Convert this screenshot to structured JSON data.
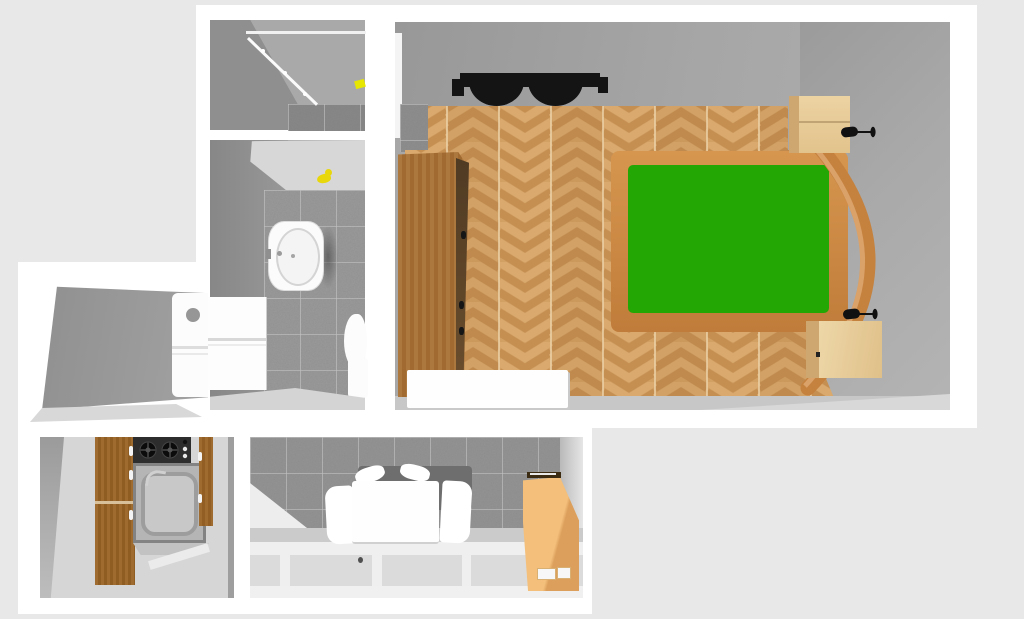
{
  "scene": {
    "description": "3D top-down rendered floor plan of a small apartment",
    "background_color": "#e8e8e8",
    "wall_color": "#ffffff",
    "interior_gray": "#a7a7a7"
  },
  "rooms": [
    {
      "id": "shower-room",
      "position": "top-left",
      "floor": "dark speckled tile",
      "items": [
        "diagonal glass shower door",
        "yellow accessory on wall"
      ]
    },
    {
      "id": "bathroom",
      "position": "mid-left",
      "floor": "gray speckled tile",
      "items": [
        "wall-mounted washbasin",
        "toilet",
        "white storage cabinet",
        "yellow rubber duck"
      ]
    },
    {
      "id": "utility-room",
      "position": "left",
      "items": [
        "white appliance with round dial"
      ]
    },
    {
      "id": "bedroom",
      "position": "right",
      "floor": "herringbone oak parquet",
      "items": [
        "double bed with green mattress",
        "curved wooden headboard",
        "tall wooden wardrobe with dark handles",
        "white sideboard",
        "nightstand with black desk lamp (top)",
        "nightstand with black desk lamp (bottom)",
        "black wall-mounted fixture"
      ]
    },
    {
      "id": "kitchen",
      "position": "bottom-left",
      "items": [
        "wooden cabinet run with white handles",
        "two-burner gas cooktop",
        "gray countertop with sink and faucet"
      ]
    },
    {
      "id": "dining-room",
      "position": "bottom-center",
      "wall": "gray speckled tile",
      "floor": "light panels with white joints",
      "items": [
        "white dining table",
        "white chairs",
        "tan storage cabinet"
      ]
    }
  ],
  "colors": {
    "parquet_light": "#d8a76c",
    "parquet_dark": "#c68f52",
    "mattress_green": "#23a705",
    "bed_frame": "#c5823f",
    "wardrobe_wood": "#a06a31",
    "nightstand_wood": "#e8cf9e",
    "dining_cabinet_tan": "#f0b56a",
    "kitchen_wood": "#9c682c",
    "tile_gray": "#9a9a9a",
    "accent_yellow": "#e8d70a",
    "fixture_black": "#141414"
  }
}
